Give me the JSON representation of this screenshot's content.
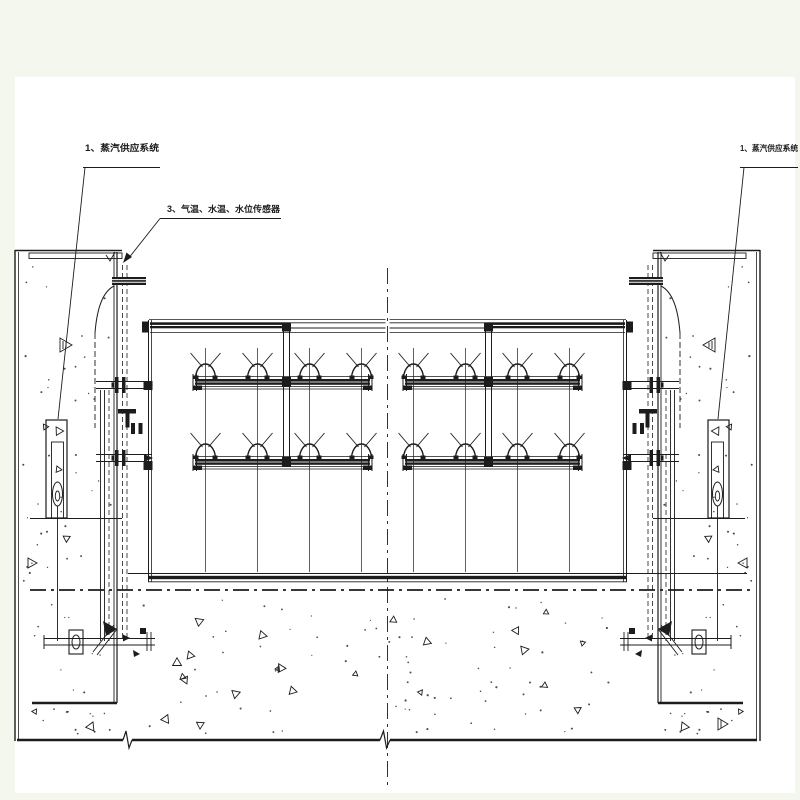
{
  "annotations": {
    "steam_supply_left": "1、蒸汽供应系统",
    "sensors": "3、气温、水温、水位传感器",
    "steam_supply_right": "1、蒸汽供应系统"
  },
  "colors": {
    "ink": "#1c1c1c",
    "paper": "#ffffff",
    "margin": "#f4f7ee"
  }
}
